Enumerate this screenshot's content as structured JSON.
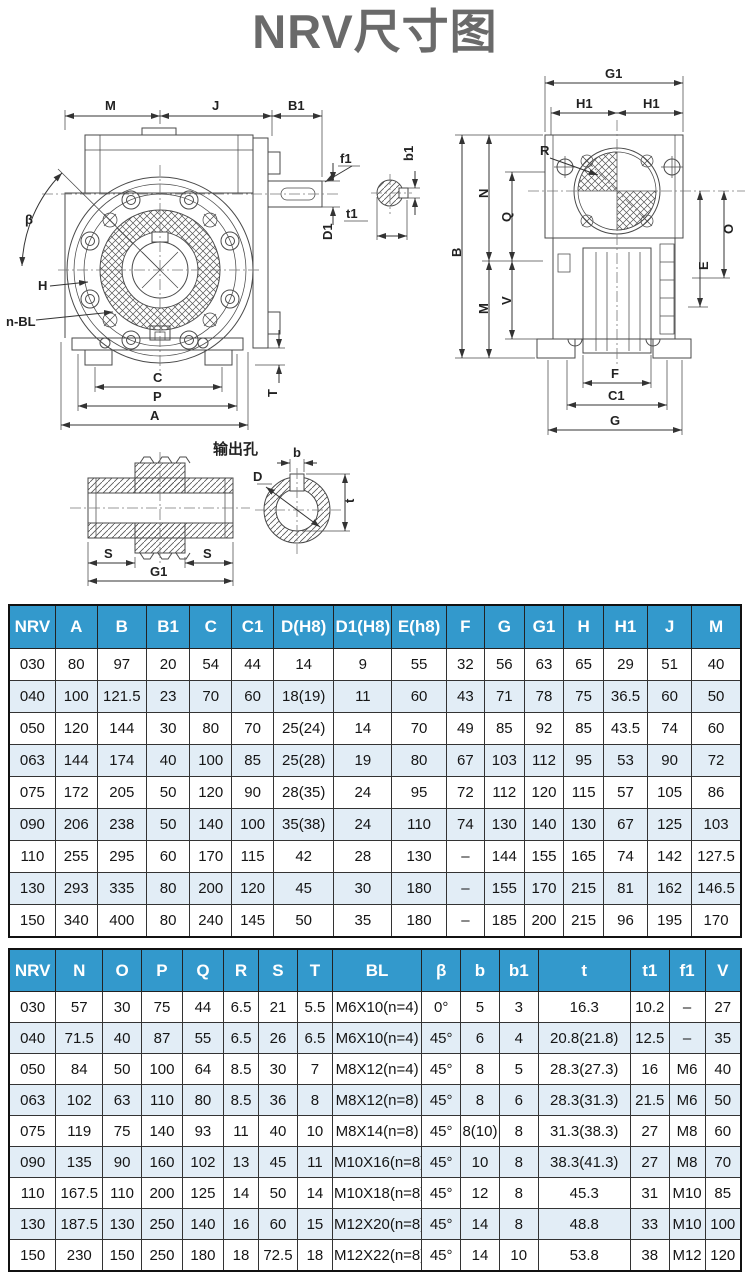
{
  "title": "NRV尺寸图",
  "colors": {
    "header_bg": "#3399cc",
    "header_text": "#ffffff",
    "row_alt_bg": "#e2edf6",
    "row_bg": "#ffffff",
    "title_color": "#6a6a6a",
    "line_color": "#4a4a4a"
  },
  "diagram": {
    "output_hole_caption": "输出孔",
    "labels": {
      "M": "M",
      "J": "J",
      "B1": "B1",
      "beta": "β",
      "H": "H",
      "nBL": "n-BL",
      "C": "C",
      "P": "P",
      "A": "A",
      "T": "T",
      "f1": "f1",
      "t1": "t1",
      "D1": "D1",
      "b1": "b1",
      "G1": "G1",
      "H1a": "H1",
      "H1b": "H1",
      "R": "R",
      "B": "B",
      "N": "N",
      "Q": "Q",
      "M2": "M",
      "V": "V",
      "O": "O",
      "E": "E",
      "F": "F",
      "C1": "C1",
      "G": "G",
      "S1": "S",
      "S2": "S",
      "G1b": "G1",
      "D": "D",
      "b": "b",
      "t": "t"
    }
  },
  "table1": {
    "headers": [
      "NRV",
      "A",
      "B",
      "B1",
      "C",
      "C1",
      "D(H8)",
      "D1(H8)",
      "E(h8)",
      "F",
      "G",
      "G1",
      "H",
      "H1",
      "J",
      "M"
    ],
    "rows": [
      [
        "030",
        "80",
        "97",
        "20",
        "54",
        "44",
        "14",
        "9",
        "55",
        "32",
        "56",
        "63",
        "65",
        "29",
        "51",
        "40"
      ],
      [
        "040",
        "100",
        "121.5",
        "23",
        "70",
        "60",
        "18(19)",
        "11",
        "60",
        "43",
        "71",
        "78",
        "75",
        "36.5",
        "60",
        "50"
      ],
      [
        "050",
        "120",
        "144",
        "30",
        "80",
        "70",
        "25(24)",
        "14",
        "70",
        "49",
        "85",
        "92",
        "85",
        "43.5",
        "74",
        "60"
      ],
      [
        "063",
        "144",
        "174",
        "40",
        "100",
        "85",
        "25(28)",
        "19",
        "80",
        "67",
        "103",
        "112",
        "95",
        "53",
        "90",
        "72"
      ],
      [
        "075",
        "172",
        "205",
        "50",
        "120",
        "90",
        "28(35)",
        "24",
        "95",
        "72",
        "112",
        "120",
        "115",
        "57",
        "105",
        "86"
      ],
      [
        "090",
        "206",
        "238",
        "50",
        "140",
        "100",
        "35(38)",
        "24",
        "110",
        "74",
        "130",
        "140",
        "130",
        "67",
        "125",
        "103"
      ],
      [
        "110",
        "255",
        "295",
        "60",
        "170",
        "115",
        "42",
        "28",
        "130",
        "–",
        "144",
        "155",
        "165",
        "74",
        "142",
        "127.5"
      ],
      [
        "130",
        "293",
        "335",
        "80",
        "200",
        "120",
        "45",
        "30",
        "180",
        "–",
        "155",
        "170",
        "215",
        "81",
        "162",
        "146.5"
      ],
      [
        "150",
        "340",
        "400",
        "80",
        "240",
        "145",
        "50",
        "35",
        "180",
        "–",
        "185",
        "200",
        "215",
        "96",
        "195",
        "170"
      ]
    ]
  },
  "table2": {
    "headers": [
      "NRV",
      "N",
      "O",
      "P",
      "Q",
      "R",
      "S",
      "T",
      "BL",
      "β",
      "b",
      "b1",
      "t",
      "t1",
      "f1",
      "V"
    ],
    "rows": [
      [
        "030",
        "57",
        "30",
        "75",
        "44",
        "6.5",
        "21",
        "5.5",
        "M6X10(n=4)",
        "0°",
        "5",
        "3",
        "16.3",
        "10.2",
        "–",
        "27"
      ],
      [
        "040",
        "71.5",
        "40",
        "87",
        "55",
        "6.5",
        "26",
        "6.5",
        "M6X10(n=4)",
        "45°",
        "6",
        "4",
        "20.8(21.8)",
        "12.5",
        "–",
        "35"
      ],
      [
        "050",
        "84",
        "50",
        "100",
        "64",
        "8.5",
        "30",
        "7",
        "M8X12(n=4)",
        "45°",
        "8",
        "5",
        "28.3(27.3)",
        "16",
        "M6",
        "40"
      ],
      [
        "063",
        "102",
        "63",
        "110",
        "80",
        "8.5",
        "36",
        "8",
        "M8X12(n=8)",
        "45°",
        "8",
        "6",
        "28.3(31.3)",
        "21.5",
        "M6",
        "50"
      ],
      [
        "075",
        "119",
        "75",
        "140",
        "93",
        "11",
        "40",
        "10",
        "M8X14(n=8)",
        "45°",
        "8(10)",
        "8",
        "31.3(38.3)",
        "27",
        "M8",
        "60"
      ],
      [
        "090",
        "135",
        "90",
        "160",
        "102",
        "13",
        "45",
        "11",
        "M10X16(n=8)",
        "45°",
        "10",
        "8",
        "38.3(41.3)",
        "27",
        "M8",
        "70"
      ],
      [
        "110",
        "167.5",
        "110",
        "200",
        "125",
        "14",
        "50",
        "14",
        "M10X18(n=8)",
        "45°",
        "12",
        "8",
        "45.3",
        "31",
        "M10",
        "85"
      ],
      [
        "130",
        "187.5",
        "130",
        "250",
        "140",
        "16",
        "60",
        "15",
        "M12X20(n=8)",
        "45°",
        "14",
        "8",
        "48.8",
        "33",
        "M10",
        "100"
      ],
      [
        "150",
        "230",
        "150",
        "250",
        "180",
        "18",
        "72.5",
        "18",
        "M12X22(n=8)",
        "45°",
        "14",
        "10",
        "53.8",
        "38",
        "M12",
        "120"
      ]
    ]
  }
}
